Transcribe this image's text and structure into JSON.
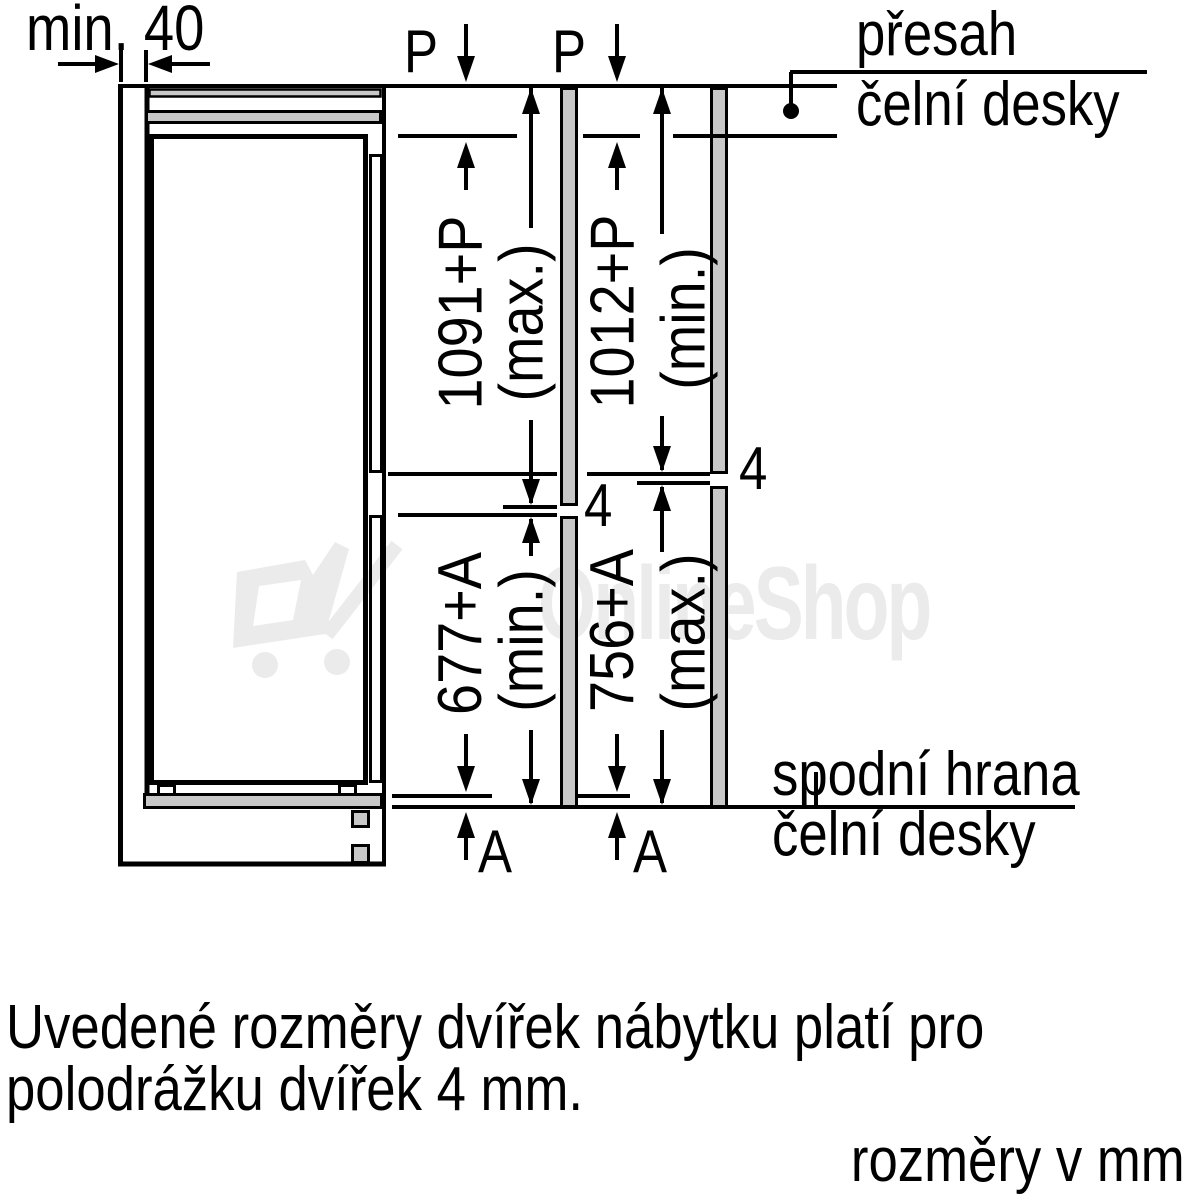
{
  "title": "installation-dimensions-diagram",
  "colors": {
    "line": "#000000",
    "panel_gray": "#c8c8c8",
    "watermark_gray": "#ebebeb",
    "background": "#ffffff"
  },
  "labels": {
    "min_gap": "min. 40",
    "p_left": "P",
    "p_right": "P",
    "gap_left": "4",
    "gap_right": "4",
    "overhang_left": "A",
    "overhang_right": "A"
  },
  "callouts": {
    "top_line1": "přesah",
    "top_line2": "čelní desky",
    "bottom_line1": "spodní hrana",
    "bottom_line2": "čelní desky"
  },
  "dimensions": {
    "upper_left": {
      "value": "1091+P",
      "qualifier": "(max.)"
    },
    "upper_right": {
      "value": "1012+P",
      "qualifier": "(min.)"
    },
    "lower_left": {
      "value": "677+A",
      "qualifier": "(min.)"
    },
    "lower_right": {
      "value": "756+A",
      "qualifier": "(max.)"
    }
  },
  "note": {
    "line1": "Uvedené rozměry dvířek nábytku platí pro",
    "line2": "polodrážku dvířek 4 mm.",
    "units": "rozměry v mm"
  },
  "watermark": {
    "text": "OnlineShop"
  }
}
